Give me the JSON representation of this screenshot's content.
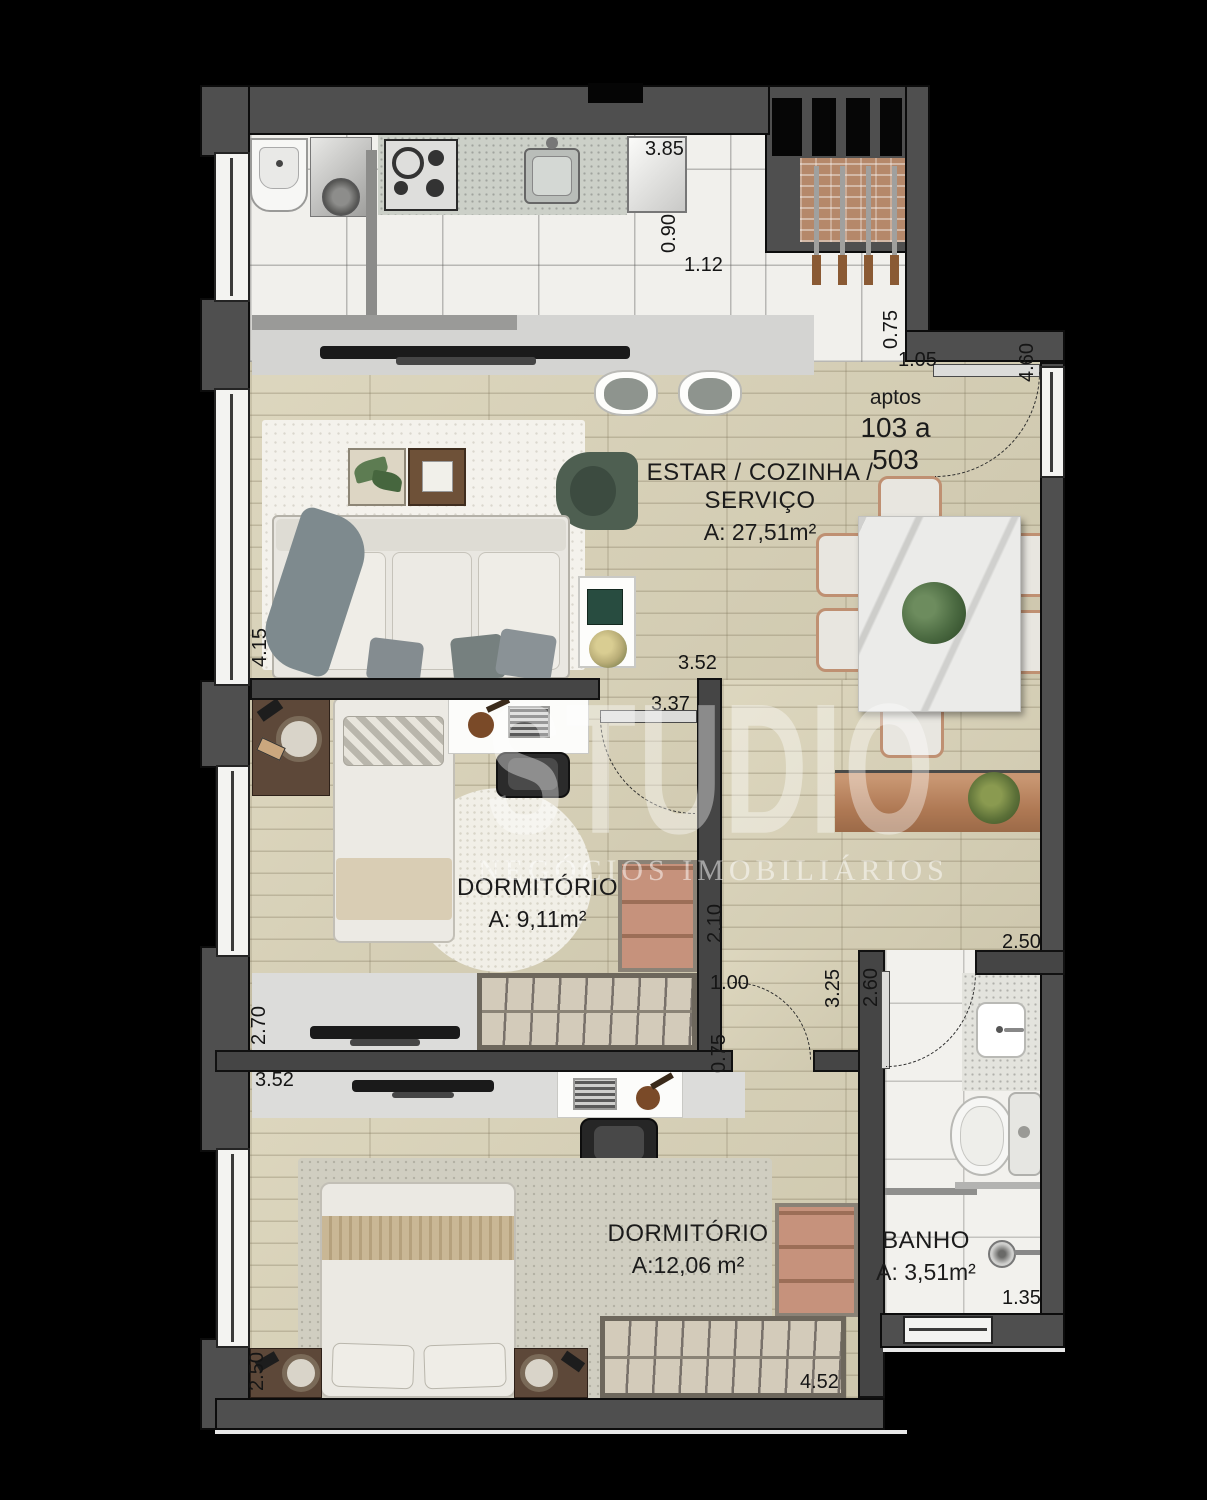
{
  "unit": {
    "line1": "aptos",
    "line2": "103 a 503"
  },
  "rooms": {
    "living": {
      "name": "ESTAR / COZINHA / SERVIÇO",
      "area": "A: 27,51m²"
    },
    "bedroom1": {
      "name": "DORMITÓRIO",
      "area": "A: 9,11m²"
    },
    "bedroom2": {
      "name": "DORMITÓRIO",
      "area": "A:12,06 m²"
    },
    "bath": {
      "name": "BANHO",
      "area": "A: 3,51m²"
    }
  },
  "dims": [
    {
      "label": "3.85"
    },
    {
      "label": "0.90"
    },
    {
      "label": "1.12"
    },
    {
      "label": "0.75"
    },
    {
      "label": "1.05"
    },
    {
      "label": "4.60"
    },
    {
      "label": "4.15"
    },
    {
      "label": "3.52"
    },
    {
      "label": "3.37"
    },
    {
      "label": "2.10"
    },
    {
      "label": "2.50"
    },
    {
      "label": "1.00"
    },
    {
      "label": "3.25"
    },
    {
      "label": "2.60"
    },
    {
      "label": "0.75"
    },
    {
      "label": "2.70"
    },
    {
      "label": "3.52"
    },
    {
      "label": "2.50"
    },
    {
      "label": "4.52"
    },
    {
      "label": "1.35"
    }
  ],
  "watermark": {
    "brand": "STUDIO",
    "tagline": "NEGÓCIOS IMOBILIÁRIOS"
  },
  "colors": {
    "background": "#000000",
    "wall": "#4f4f4f",
    "wood_floor": "#d9d2b7",
    "tile_floor": "#f1f0ec",
    "counter_gray": "#dcdcda",
    "brick_shaft": "#b5886a",
    "armchair_green": "#4e5f51",
    "wood_furniture": "#c28e6d",
    "wardrobe_salmon": "#c6927c"
  }
}
